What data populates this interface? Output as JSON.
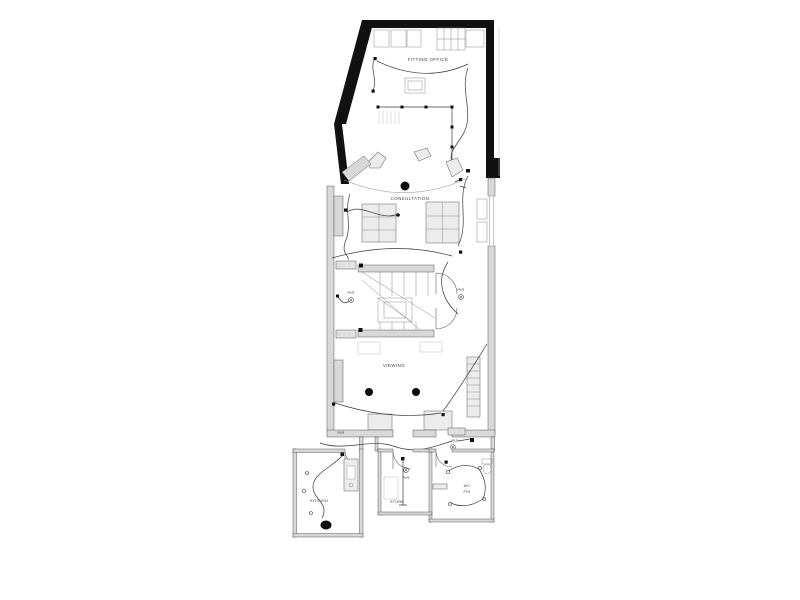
{
  "plan": {
    "rooms": {
      "fitting_office": "FITTING OFFICE",
      "consultation": "CONSULTATION",
      "viewing": "VIEWING",
      "kitchen": "KITCHEN",
      "store": "STORE",
      "wc": "WC"
    },
    "annotations": {
      "pir": "PIR"
    },
    "colors": {
      "background": "#ffffff",
      "solid_wall": "#111111",
      "wall_fill": "#d8d8d8",
      "drawing_line": "#4a4a4a",
      "label_text": "#3d3d3d"
    },
    "symbols": {
      "ceiling_light": "filled-black-dot",
      "pir_sensor": "small-double-circle",
      "socket": "small-black-square"
    }
  }
}
